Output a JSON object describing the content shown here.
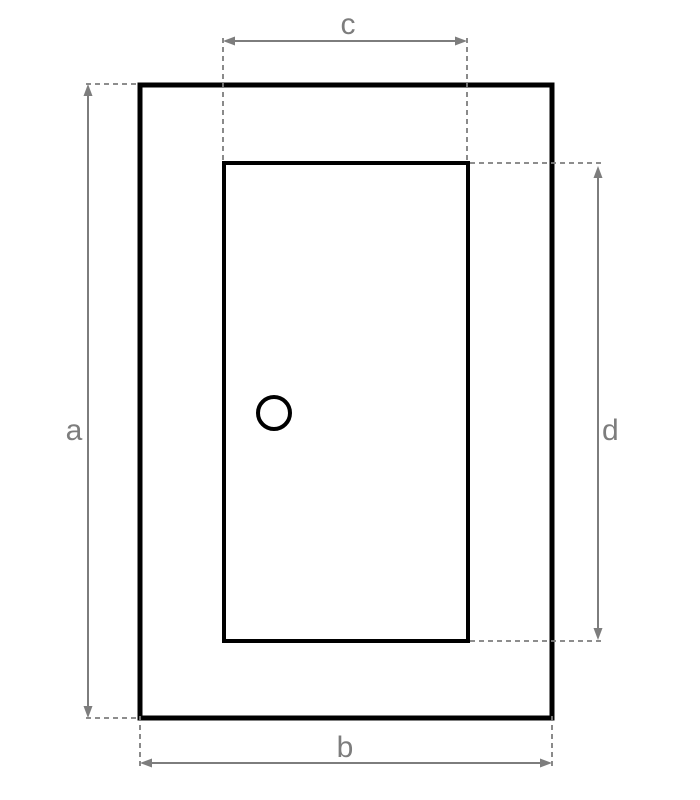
{
  "colors": {
    "background": "#ffffff",
    "shape_outline": "#000000",
    "dimension_line": "#7d7d7d",
    "label_text": "#7d7d7d"
  },
  "shapes": {
    "outer_rectangle": "outer frame rectangle",
    "inner_rectangle": "inner panel rectangle",
    "knob_circle": "small circle on inner panel"
  },
  "dimensions": [
    {
      "label": "a",
      "orientation": "vertical",
      "side": "left",
      "measures": "outer-rectangle-height"
    },
    {
      "label": "b",
      "orientation": "horizontal",
      "side": "bottom",
      "measures": "outer-rectangle-width"
    },
    {
      "label": "c",
      "orientation": "horizontal",
      "side": "top",
      "measures": "inner-rectangle-width"
    },
    {
      "label": "d",
      "orientation": "vertical",
      "side": "right",
      "measures": "inner-rectangle-height"
    }
  ]
}
